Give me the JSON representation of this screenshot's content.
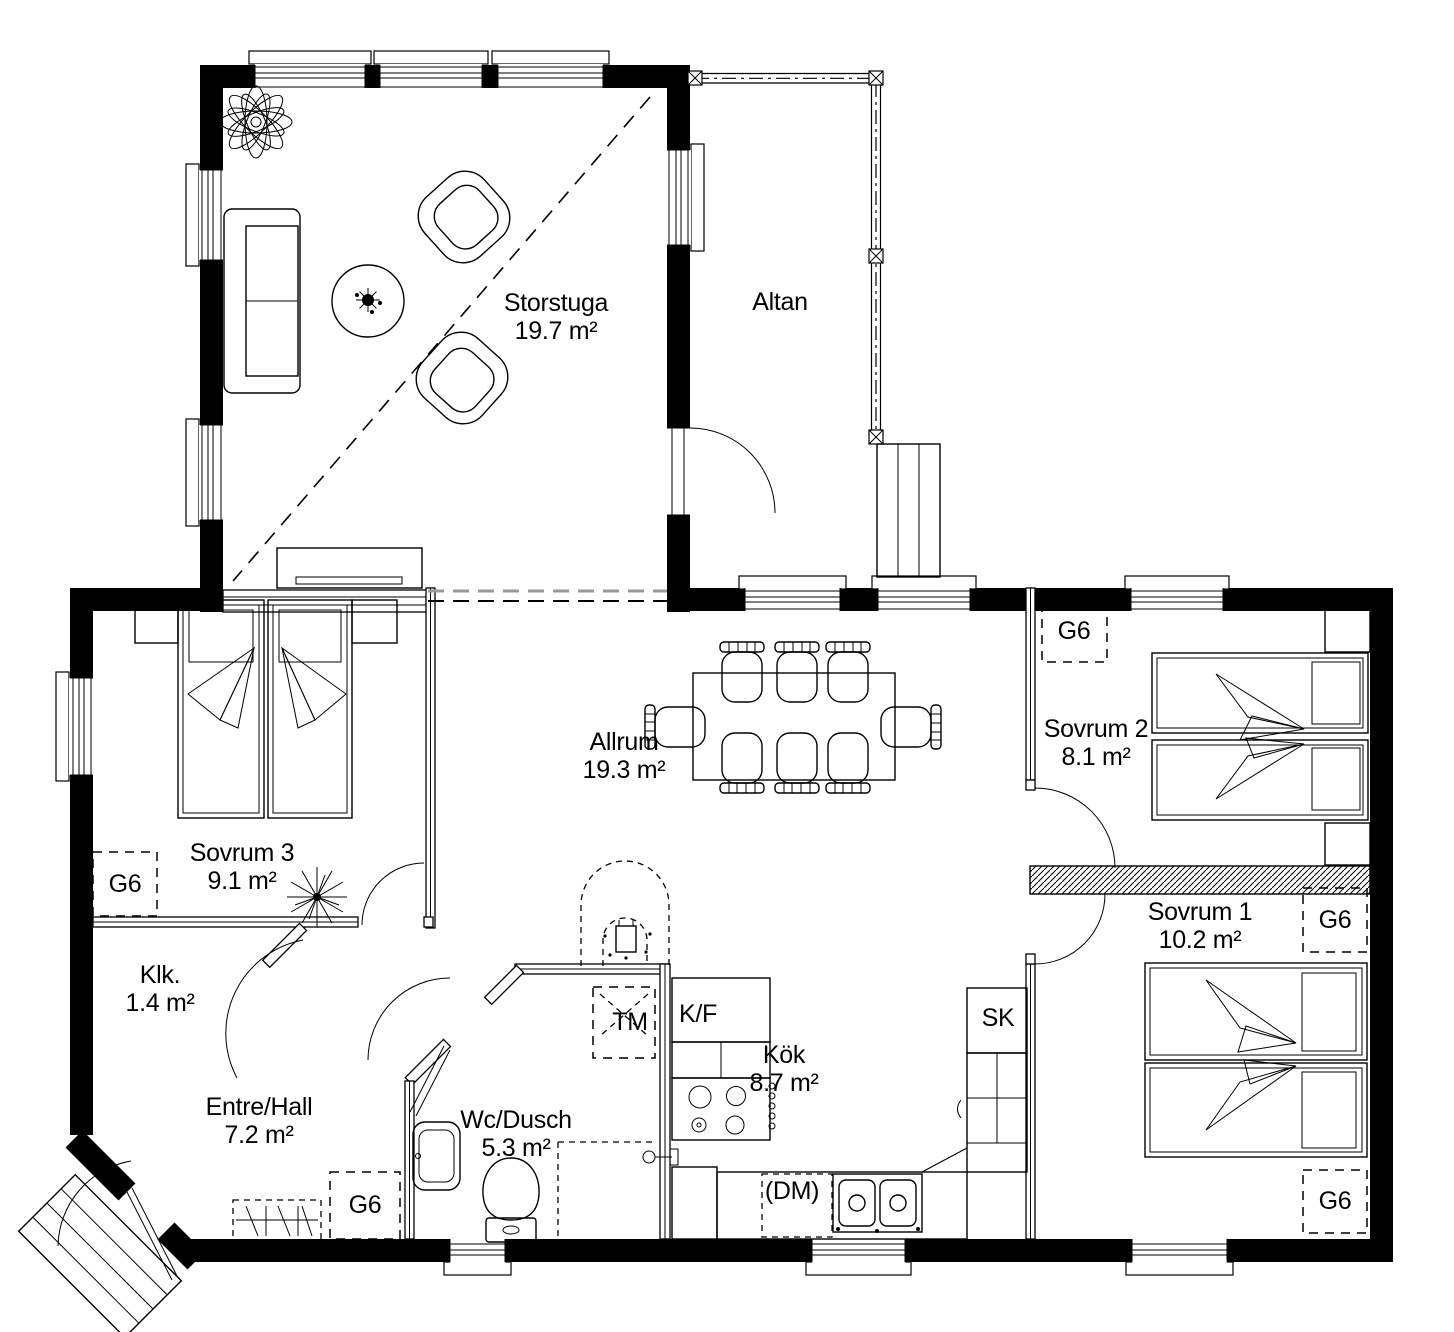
{
  "plan": {
    "rooms": [
      {
        "key": "storstuga",
        "label": "Storstuga",
        "area": "19.7 m²"
      },
      {
        "key": "altan",
        "label": "Altan",
        "area": ""
      },
      {
        "key": "allrum",
        "label": "Allrum",
        "area": "19.3 m²"
      },
      {
        "key": "sovrum3",
        "label": "Sovrum 3",
        "area": "9.1 m²"
      },
      {
        "key": "sovrum2",
        "label": "Sovrum 2",
        "area": "8.1 m²"
      },
      {
        "key": "sovrum1",
        "label": "Sovrum 1",
        "area": "10.2 m²"
      },
      {
        "key": "klk",
        "label": "Klk.",
        "area": "1.4 m²"
      },
      {
        "key": "entre",
        "label": "Entre/Hall",
        "area": "7.2 m²"
      },
      {
        "key": "wc",
        "label": "Wc/Dusch",
        "area": "5.3 m²"
      },
      {
        "key": "kok",
        "label": "Kök",
        "area": "8.7 m²"
      }
    ],
    "fixtures": {
      "wardrobe": "G6",
      "fridge_freezer": "K/F",
      "tall_cabinet": "SK",
      "washing_machine": "TM",
      "dishwasher": "(DM)"
    },
    "colors": {
      "wall": "#000000",
      "line": "#000000",
      "background": "#ffffff"
    }
  }
}
